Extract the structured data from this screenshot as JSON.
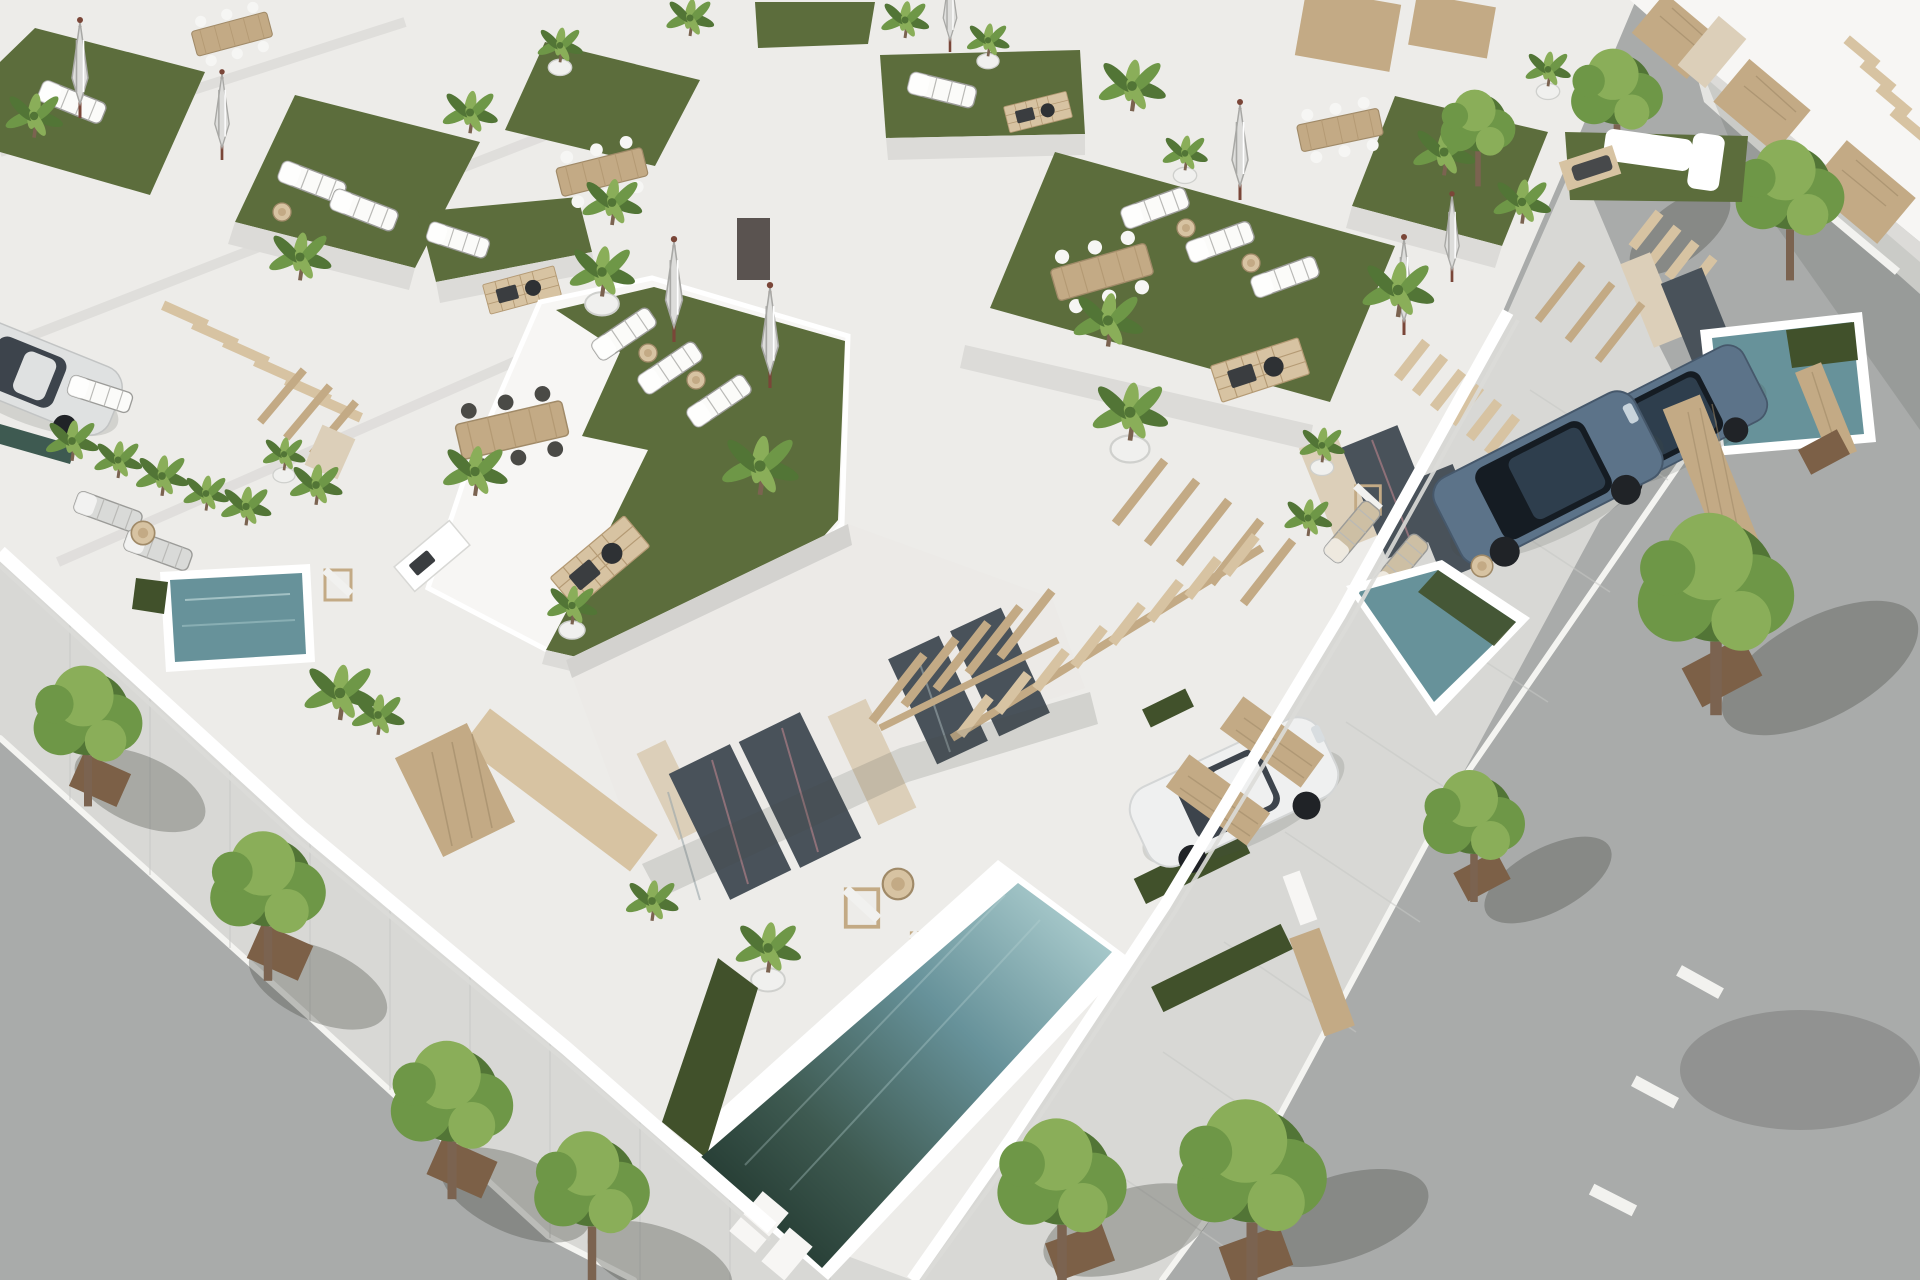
{
  "meta": {
    "domain": "Natural-Image",
    "description": "Aerial 3D architectural render of a block of modern white villas with rooftop lawn terraces, sun loungers, folded umbrellas, potted palms, private pools, parked cars and tree-lined streets on two sides"
  },
  "palette": {
    "base": "#edece9",
    "wallLight": "#f7f6f4",
    "wall": "#eceae7",
    "wallShade": "#dcdbd8",
    "wallDark": "#c7c6c3",
    "fasciaShade": "#d3d2cf",
    "lawn": "#5c6d3c",
    "lawnLight": "#6b7d45",
    "lawnDark": "#4a5a30",
    "grassStrip": "#41512b",
    "poolLight": "#a6c8ca",
    "poolAqua": "#7fa9ae",
    "poolMid": "#67929a",
    "poolDark": "#3e5a51",
    "poolDeep": "#233930",
    "wood": "#c3aa85",
    "woodLight": "#d7c3a2",
    "woodDark": "#a08a68",
    "stone": "#dccfb9",
    "asphalt": "#a9abaa",
    "sidewalk": "#d8d8d5",
    "sidewalkLight": "#e4e4e1",
    "kerb": "#f4f4f1",
    "soil": "#7c6047",
    "tree": "#6e9747",
    "treeLight": "#8aae59",
    "treeDark": "#527536",
    "trunk": "#7b6350",
    "carWhite": "#eff0f0",
    "carSilver": "#dfe1e1",
    "carGlass": "#3d444c",
    "suv": "#5c7389",
    "suvDark": "#2e3e4d",
    "suvGlass": "#151c23",
    "wheel": "#202327",
    "umbrella": "#dddddb",
    "umbrellaShade": "#a8a8a5",
    "pole": "#7a4638",
    "frame": "#8e7078",
    "glass": "#49525a",
    "glassSheen": "#87989c",
    "white": "#ffffff",
    "shadow": "rgba(70,72,68,0.16)",
    "shadowDeep": "rgba(55,58,54,0.30)"
  },
  "scene": {
    "streets": {
      "count": 2,
      "surfaces": [
        "asphalt roadway",
        "paved sidewalk with square tree pits"
      ],
      "markings": "white dashed centre line on right-hand street",
      "street_trees": 10
    },
    "block": {
      "villa_rows": 4,
      "roof_terraces": "artificial lawn with sun loungers, folded parasols, potted palms, dining tables and barbecue decks",
      "stairs": "floating timber stair treads on white walls",
      "facades": "white render with natural stone piers, full-height glazing and timber pergolas"
    },
    "pools": [
      {
        "name": "hero-villa-pool",
        "shape": "long rectangle",
        "water": "aqua fading to deep green shade"
      },
      {
        "name": "right-villa-pool",
        "shape": "rectangle",
        "water": "aqua"
      },
      {
        "name": "far-right-villa-pool",
        "shape": "long rectangle",
        "water": "aqua"
      },
      {
        "name": "left-courtyard-plunge-pool",
        "shape": "square",
        "water": "textured aqua"
      },
      {
        "name": "left-edge-pool-sliver",
        "shape": "partial",
        "water": "dark teal"
      }
    ],
    "vehicles": [
      {
        "name": "white-sedan",
        "location": "hero villa driveway"
      },
      {
        "name": "silver-sedan",
        "location": "left courtyard driveway"
      },
      {
        "name": "blue-suv-near",
        "location": "right villa driveway"
      },
      {
        "name": "blue-suv-far",
        "location": "far right villa driveway"
      }
    ]
  }
}
